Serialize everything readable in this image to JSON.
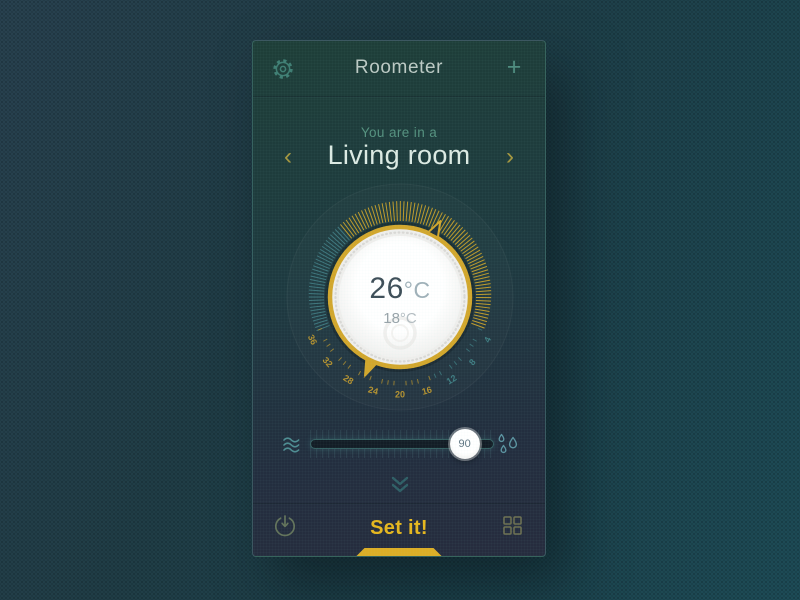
{
  "header": {
    "title": "Roometer",
    "add_icon": "+"
  },
  "room_selector": {
    "subtitle": "You are in a",
    "room_name": "Living room",
    "prev_icon": "‹",
    "next_icon": "›"
  },
  "dial": {
    "current_temp": "26",
    "current_unit": "°C",
    "secondary_temp": "18",
    "secondary_unit": "°C",
    "scale": {
      "numbers": [
        36,
        32,
        28,
        24,
        20,
        16,
        12,
        8,
        4
      ],
      "number_colors": [
        "gold",
        "gold",
        "gold",
        "gold",
        "gold",
        "gold",
        "teal",
        "teal",
        "teal"
      ],
      "min": 4,
      "max": 36,
      "step": 4
    },
    "band": {
      "start_angle": -112,
      "end_angle": 112,
      "teal_until_angle": -40
    },
    "markers": {
      "upper_angle": 28,
      "lower_angle": 204
    }
  },
  "humidity_slider": {
    "value": 90,
    "min": 0,
    "max": 100
  },
  "footer": {
    "set_label": "Set it!"
  },
  "colors": {
    "gold": "#bf9b2b",
    "ring_gold": "#d2a62c",
    "teal_tick": "#3e767d",
    "number_gold": "#b5922f",
    "number_teal": "#3f7d82",
    "accent_text": "#e6b71e"
  }
}
